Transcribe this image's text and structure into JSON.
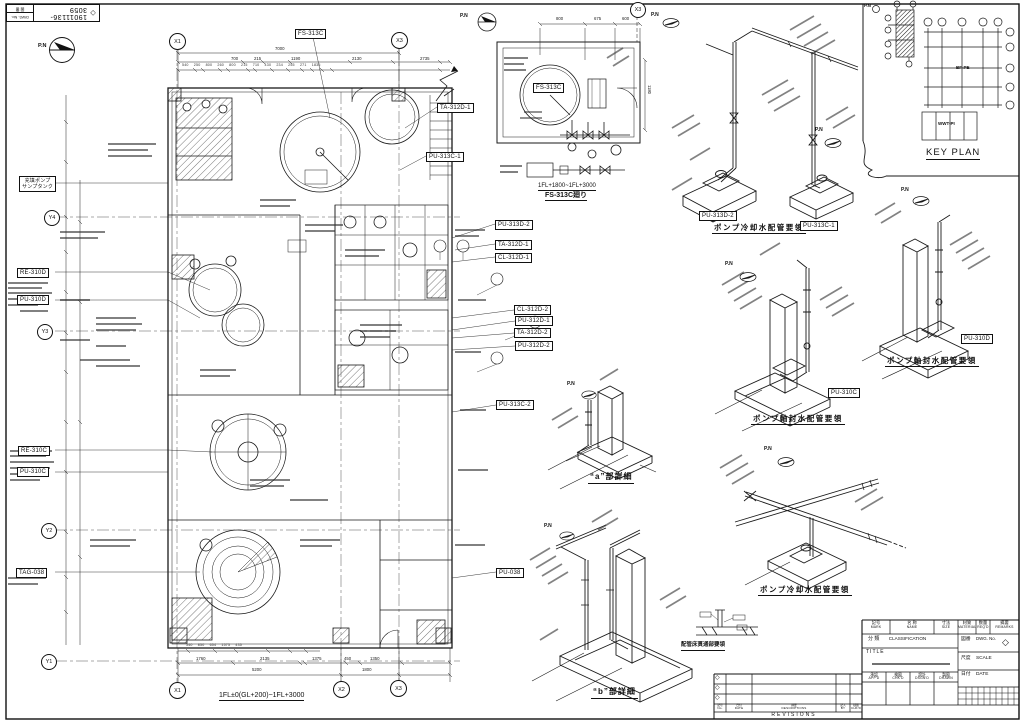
{
  "sheet": {
    "pn": "P.N"
  },
  "stamp": {
    "number": "19011136-3059",
    "dwg_label": "DWG. No.",
    "zuban": "図 番",
    "diamond": "◇"
  },
  "plan": {
    "grid": {
      "x1": "X1",
      "x2": "X2",
      "x3": "X3",
      "y1": "Y1",
      "y2": "Y2",
      "y3": "Y3",
      "y4": "Y4"
    },
    "equipment": {
      "fs313c": "FS-313C",
      "fill_pump_1": "充填ポンプ",
      "fill_pump_2": "サンプタンク",
      "re310d": "RE-310D",
      "pu310d": "PU-310D",
      "re310c": "RE-310C",
      "pu310c": "PU-310C",
      "tag038": "TAG-038",
      "pu038": "PU-038",
      "pu313c1": "PU-313C-1",
      "ta312d1": "TA-312D-1",
      "pu313d2": "PU-313D-2",
      "cl312d1": "CL-312D-1",
      "cl312d2": "CL-312D-2",
      "pu312d1": "PU-312D-1",
      "ta312d2": "TA-312D-2",
      "pu312d2": "PU-312D-2",
      "pu313c2": "PU-313C-2"
    },
    "dims_top": {
      "total": "7000",
      "segs": [
        "700",
        "215",
        "1190",
        "2130",
        "2735"
      ],
      "sub": "540 250 800 260 800 215 710 430 234 255 271 1835"
    },
    "dims_bottom": {
      "sub": "340 850 654 1575 435",
      "segs": [
        "1760",
        "2135",
        "1375",
        "450",
        "1350"
      ],
      "totals": [
        "5200",
        "1800"
      ]
    },
    "caption": "1FL±0(GL+200)~1FL+3000"
  },
  "detail_fs": {
    "tank": "FS-313C",
    "dims": [
      "800",
      "675",
      "600"
    ],
    "dim_h": "1180",
    "cap1": "1FL+1800~1FL+3000",
    "cap2": "FS-313C廻り"
  },
  "iso": {
    "cooling_caption": "ポンプ冷却水配管要領",
    "seal_caption": "ポンプ軸封水配管要領",
    "detail_a": "“a”部詳細",
    "detail_b": "“b”部詳細",
    "floor_caption": "配管床貫通部要領",
    "pu313d2": "PU-313D-2",
    "pu313c1": "PU-313C-1",
    "pu310c": "PU-310C",
    "pu310d": "PU-310D"
  },
  "key_plan": {
    "title": "KEY PLAN",
    "bfpe": "BF-PE",
    "wwtpi": "WWT-PI"
  },
  "tb": {
    "parts": [
      {
        "jp": "記号",
        "en": "MARK"
      },
      {
        "jp": "名 称",
        "en": "NAME"
      },
      {
        "jp": "寸法",
        "en": "SIZE"
      },
      {
        "jp": "材質",
        "en": "MATERIAL"
      },
      {
        "jp": "数量",
        "en": "REQ'D"
      },
      {
        "jp": "摘要",
        "en": "REMARKS"
      }
    ],
    "cls_jp": "分 類",
    "cls_en": "CLASSIFICATION",
    "dwg_jp": "図番",
    "dwg_en": "DWG. No.",
    "diamond": "◇",
    "title": "TITLE",
    "scale_jp": "尺度",
    "scale_en": "SCALE",
    "date_jp": "日付",
    "date_en": "DATE",
    "sign": [
      {
        "jp": "承認",
        "en": "APP'D"
      },
      {
        "jp": "検図",
        "en": "CHK'D"
      },
      {
        "jp": "設計",
        "en": "DSGN'D"
      },
      {
        "jp": "製図",
        "en": "DRAWN"
      }
    ],
    "rev": {
      "label": "REVISIONS",
      "cols": [
        {
          "jp": "記号",
          "en": "No."
        },
        {
          "jp": "日付",
          "en": "DATE"
        },
        {
          "jp": "摘要",
          "en": "DESCRIPTIONS"
        },
        {
          "jp": "記入",
          "en": "BY"
        },
        {
          "jp": "検図",
          "en": "CHK'D"
        }
      ],
      "marks": [
        "◇",
        "◇",
        "◇"
      ]
    }
  }
}
